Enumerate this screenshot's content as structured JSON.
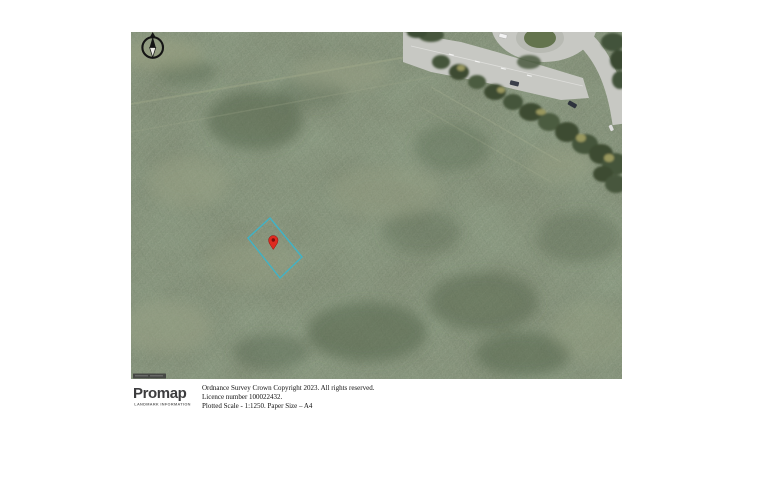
{
  "map": {
    "field_base_color": "#75816a",
    "road_color": "#c7c8c3",
    "plot_boundary_color": "#3fb3c7",
    "marker_color": "#de2b20",
    "marker_dot_color": "#7a100d"
  },
  "compass": {
    "icon": "north-arrow"
  },
  "footer": {
    "brand": "Promap",
    "brand_tagline": "LANDMARK INFORMATION",
    "brand_accent_color": "#f2a900",
    "copyright_lines": [
      "Ordnance Survey Crown Copyright 2023. All rights reserved.",
      "Licence number 100022432.",
      "Plotted Scale - 1:1250. Paper Size – A4"
    ]
  }
}
